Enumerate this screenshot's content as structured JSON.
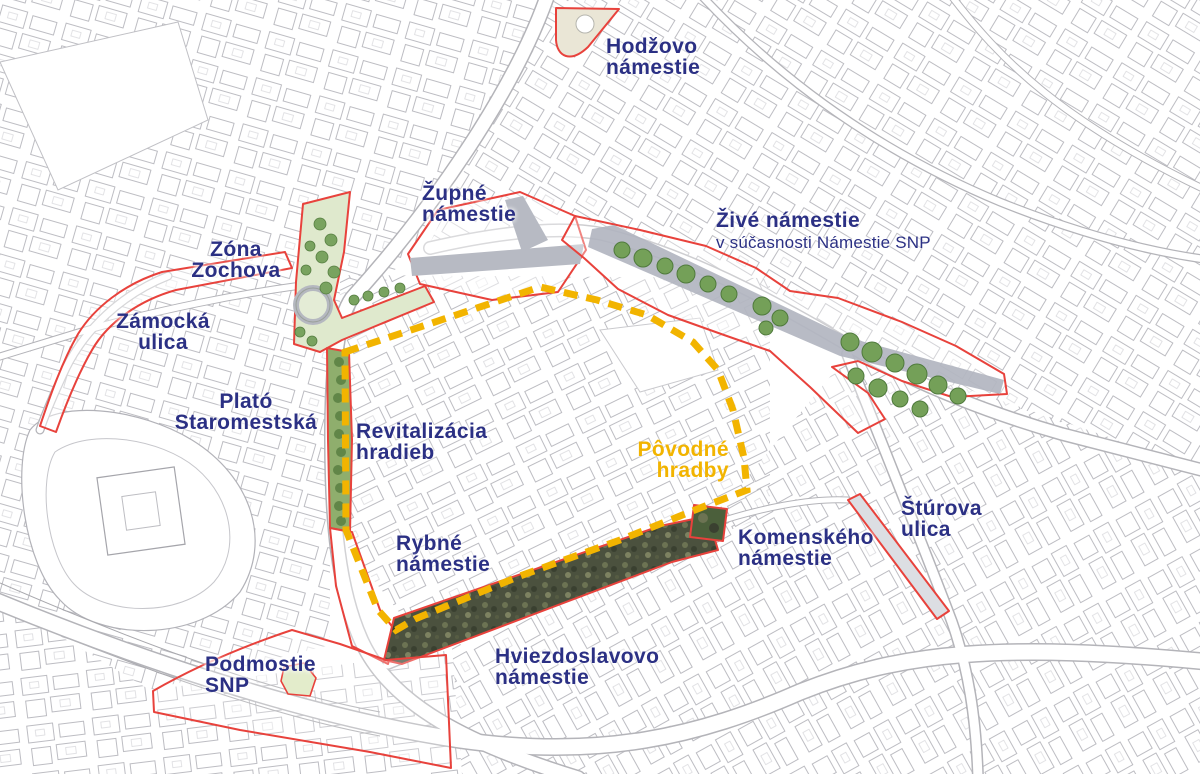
{
  "map": {
    "title": "Bratislava city-centre public space zones",
    "colors": {
      "label_navy": "#2b3084",
      "zone_outline_red": "#e8423c",
      "wall_dash_yellow": "#f2b400",
      "park_green": "#74a058",
      "road_gray": "#b3b6c0"
    }
  },
  "labels": [
    {
      "id": "hodzovo",
      "line1": "Hodžovo",
      "line2": "námestie"
    },
    {
      "id": "zupne",
      "line1": "Župné",
      "line2": "námestie"
    },
    {
      "id": "zive",
      "line1": "Živé námestie",
      "line2": "v súčasnosti Námestie SNP"
    },
    {
      "id": "zochova",
      "line1": "Zóna",
      "line2": "Zochova"
    },
    {
      "id": "zamocka",
      "line1": "Zámocká",
      "line2": "ulica"
    },
    {
      "id": "plato",
      "line1": "Plató",
      "line2": "Staromestská"
    },
    {
      "id": "revitalizacia",
      "line1": "Revitalizácia",
      "line2": "hradieb"
    },
    {
      "id": "povodne-hradby",
      "line1": "Pôvodné",
      "line2": "hradby"
    },
    {
      "id": "rybne",
      "line1": "Rybné",
      "line2": "námestie"
    },
    {
      "id": "komenskeho",
      "line1": "Komenského",
      "line2": "námestie"
    },
    {
      "id": "sturova",
      "line1": "Štúrova",
      "line2": "ulica"
    },
    {
      "id": "hviezdoslavovo",
      "line1": "Hviezdoslavovo",
      "line2": "námestie"
    },
    {
      "id": "podmostie",
      "line1": "Podmostie",
      "line2": "SNP"
    }
  ]
}
